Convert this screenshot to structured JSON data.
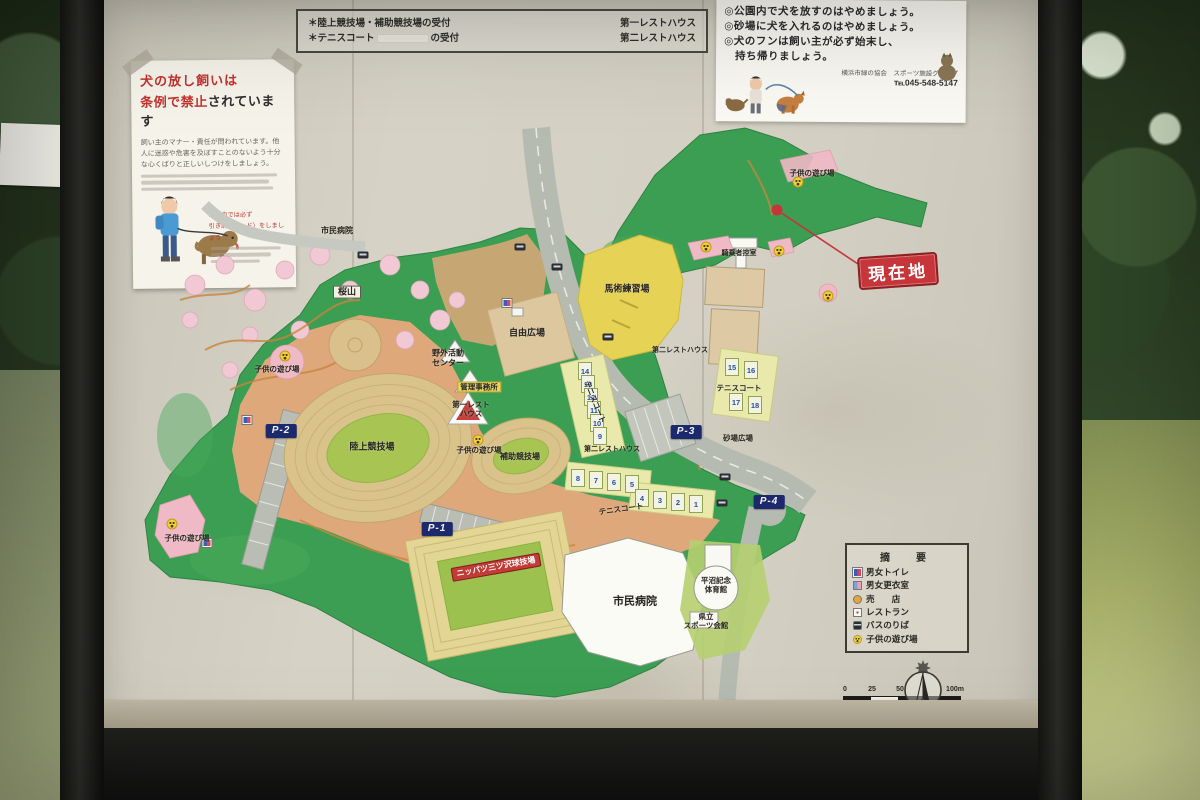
{
  "board": {
    "reception_note": {
      "rows": [
        {
          "left": "＊陸上競技場・補助競技場の受付",
          "right": "第一レストハウス",
          "redacted": false
        },
        {
          "left_pre": "＊テニスコート",
          "left_post": "の受付",
          "right": "第二レストハウス",
          "redacted": true
        }
      ]
    },
    "dog_sign": {
      "lines": [
        "◎公園内で犬を放すのはやめましょう。",
        "◎砂場に犬を入れるのはやめましょう。",
        "◎犬のフンは飼い主が必ず始末し、",
        "　持ち帰りましょう。"
      ],
      "org": "横浜市緑の協会　スポーツ施設グループ",
      "tel": "℡045-548-5147"
    },
    "leash_sign": {
      "title_line1": "犬の放し飼いは",
      "title_line2_red": "条例で禁止",
      "title_line2_black": "されています",
      "body": "飼い主のマナー・責任が問われています。他人に迷惑や危害を及ぼすことのないよう十分な心くばりと正しいしつけをしましょう。",
      "note_line1": "公園内では必ず",
      "note_line2": "引き綱（リード）をしましょう"
    }
  },
  "map": {
    "current_location_label": "現在地",
    "labels": [
      {
        "text": "市民病院",
        "x": 337,
        "y": 231,
        "cls": "plain",
        "fs": 8
      },
      {
        "text": "桜山",
        "x": 347,
        "y": 292,
        "cls": "box",
        "fs": 9
      },
      {
        "text": "自由広場",
        "x": 527,
        "y": 333,
        "cls": "plain",
        "fs": 9
      },
      {
        "text": "馬術練習場",
        "x": 627,
        "y": 289,
        "cls": "plain",
        "fs": 9
      },
      {
        "text": "騎乗者控室",
        "x": 739,
        "y": 254,
        "cls": "plain",
        "fs": 7
      },
      {
        "text": "子供の遊び場",
        "x": 812,
        "y": 173,
        "cls": "plain",
        "fs": 7.5
      },
      {
        "text": "子供の遊び場",
        "x": 277,
        "y": 369,
        "cls": "plain",
        "fs": 7.5
      },
      {
        "text": "子供の遊び場",
        "x": 479,
        "y": 450,
        "cls": "plain",
        "fs": 7.5
      },
      {
        "text": "子供の遊び場",
        "x": 187,
        "y": 538,
        "cls": "plain",
        "fs": 7.5
      },
      {
        "text": "野外活動\nセンター",
        "x": 448,
        "y": 358,
        "cls": "plain",
        "fs": 8
      },
      {
        "text": "管理事務所",
        "x": 479,
        "y": 387,
        "cls": "yellow",
        "fs": 7.5
      },
      {
        "text": "第一レスト\nハウス",
        "x": 471,
        "y": 409,
        "cls": "plain",
        "fs": 7.5
      },
      {
        "text": "陸上競技場",
        "x": 372,
        "y": 447,
        "cls": "plain",
        "fs": 9
      },
      {
        "text": "補助競技場",
        "x": 520,
        "y": 457,
        "cls": "plain",
        "fs": 8
      },
      {
        "text": "第二レストハウス",
        "x": 680,
        "y": 351,
        "cls": "plain",
        "fs": 7
      },
      {
        "text": "テニスコート",
        "x": 739,
        "y": 388,
        "cls": "plain",
        "fs": 7.5
      },
      {
        "text": "砂場広場",
        "x": 738,
        "y": 438,
        "cls": "plain",
        "fs": 7.5
      },
      {
        "text": "テニスコート",
        "x": 595,
        "y": 402,
        "cls": "plain",
        "fs": 7.5,
        "rot": 68
      },
      {
        "text": "第二レストハウス",
        "x": 612,
        "y": 450,
        "cls": "plain",
        "fs": 7
      },
      {
        "text": "テニスコート",
        "x": 621,
        "y": 509,
        "cls": "plain",
        "fs": 7.5,
        "rot": -8
      },
      {
        "text": "ニッパツ三ツ沢球技場",
        "x": 496,
        "y": 567,
        "cls": "redbadge",
        "fs": 8,
        "rot": -10
      },
      {
        "text": "市民病院",
        "x": 635,
        "y": 602,
        "cls": "plain",
        "fs": 11
      },
      {
        "text": "平沼記念\n体育館",
        "x": 716,
        "y": 585,
        "cls": "plain",
        "fs": 7.5
      },
      {
        "text": "県立\nスポーツ会館",
        "x": 706,
        "y": 621,
        "cls": "plain",
        "fs": 7.5
      },
      {
        "text": "P-1",
        "x": 437,
        "y": 529,
        "cls": "parking",
        "fs": 10
      },
      {
        "text": "P-2",
        "x": 281,
        "y": 431,
        "cls": "parking",
        "fs": 10
      },
      {
        "text": "P-3",
        "x": 686,
        "y": 432,
        "cls": "parking",
        "fs": 10
      },
      {
        "text": "P-4",
        "x": 769,
        "y": 502,
        "cls": "parking",
        "fs": 10
      }
    ],
    "tennis_courts": [
      {
        "n": "14",
        "x": 585,
        "y": 371
      },
      {
        "n": "13",
        "x": 588,
        "y": 384
      },
      {
        "n": "12",
        "x": 591,
        "y": 397
      },
      {
        "n": "11",
        "x": 594,
        "y": 410
      },
      {
        "n": "10",
        "x": 597,
        "y": 423
      },
      {
        "n": "9",
        "x": 600,
        "y": 436
      },
      {
        "n": "8",
        "x": 578,
        "y": 478
      },
      {
        "n": "7",
        "x": 596,
        "y": 480
      },
      {
        "n": "6",
        "x": 614,
        "y": 482
      },
      {
        "n": "5",
        "x": 632,
        "y": 484
      },
      {
        "n": "4",
        "x": 642,
        "y": 498
      },
      {
        "n": "3",
        "x": 660,
        "y": 500
      },
      {
        "n": "2",
        "x": 678,
        "y": 502
      },
      {
        "n": "1",
        "x": 696,
        "y": 504
      },
      {
        "n": "15",
        "x": 732,
        "y": 367
      },
      {
        "n": "16",
        "x": 751,
        "y": 370
      },
      {
        "n": "17",
        "x": 736,
        "y": 402
      },
      {
        "n": "18",
        "x": 755,
        "y": 405
      }
    ],
    "playground_markers": [
      {
        "x": 285,
        "y": 356
      },
      {
        "x": 172,
        "y": 524
      },
      {
        "x": 478,
        "y": 440
      },
      {
        "x": 798,
        "y": 182
      },
      {
        "x": 706,
        "y": 247
      },
      {
        "x": 779,
        "y": 251
      },
      {
        "x": 828,
        "y": 296
      }
    ],
    "toilet_markers": [
      {
        "x": 507,
        "y": 303
      },
      {
        "x": 247,
        "y": 420
      },
      {
        "x": 207,
        "y": 543
      }
    ],
    "bus_markers": [
      {
        "x": 363,
        "y": 255
      },
      {
        "x": 520,
        "y": 247
      },
      {
        "x": 557,
        "y": 267
      },
      {
        "x": 608,
        "y": 337
      },
      {
        "x": 725,
        "y": 477
      },
      {
        "x": 722,
        "y": 503
      }
    ],
    "legend": {
      "title": "摘　要",
      "items": [
        {
          "icon": "toilet-icon",
          "label": "男女トイレ"
        },
        {
          "icon": "changing-room-icon",
          "label": "男女更衣室"
        },
        {
          "icon": "shop-icon",
          "label": "売　　店"
        },
        {
          "icon": "restaurant-icon",
          "label": "レストラン"
        },
        {
          "icon": "bus-stop-icon",
          "label": "バスのりば"
        },
        {
          "icon": "playground-icon",
          "label": "子供の遊び場"
        }
      ]
    },
    "scale": {
      "ticks": [
        "0",
        "25",
        "50",
        "100m"
      ]
    }
  }
}
